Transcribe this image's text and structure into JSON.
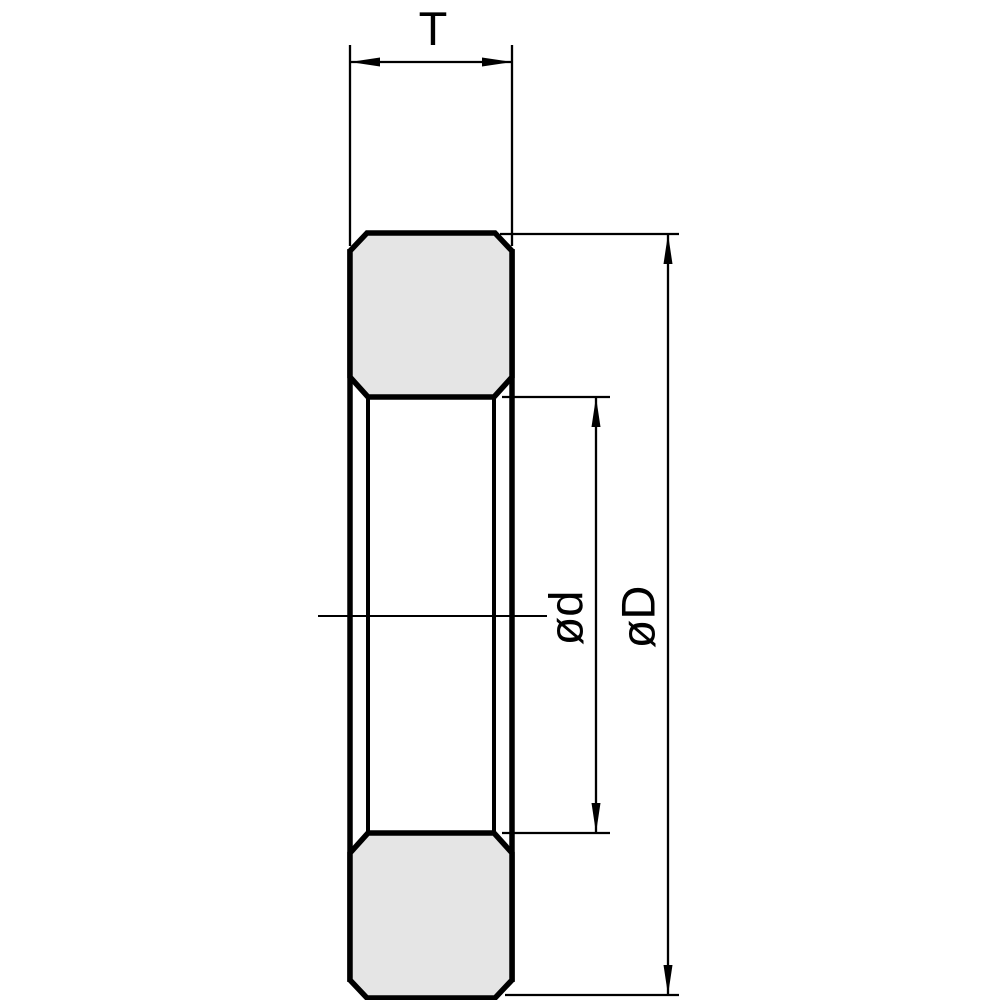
{
  "drawing": {
    "labels": {
      "thickness": "T",
      "inner_diameter": "ød",
      "outer_diameter": "øD"
    },
    "colors": {
      "line": "#000000",
      "section_fill": "#e5e5e5",
      "background": "#ffffff"
    }
  }
}
